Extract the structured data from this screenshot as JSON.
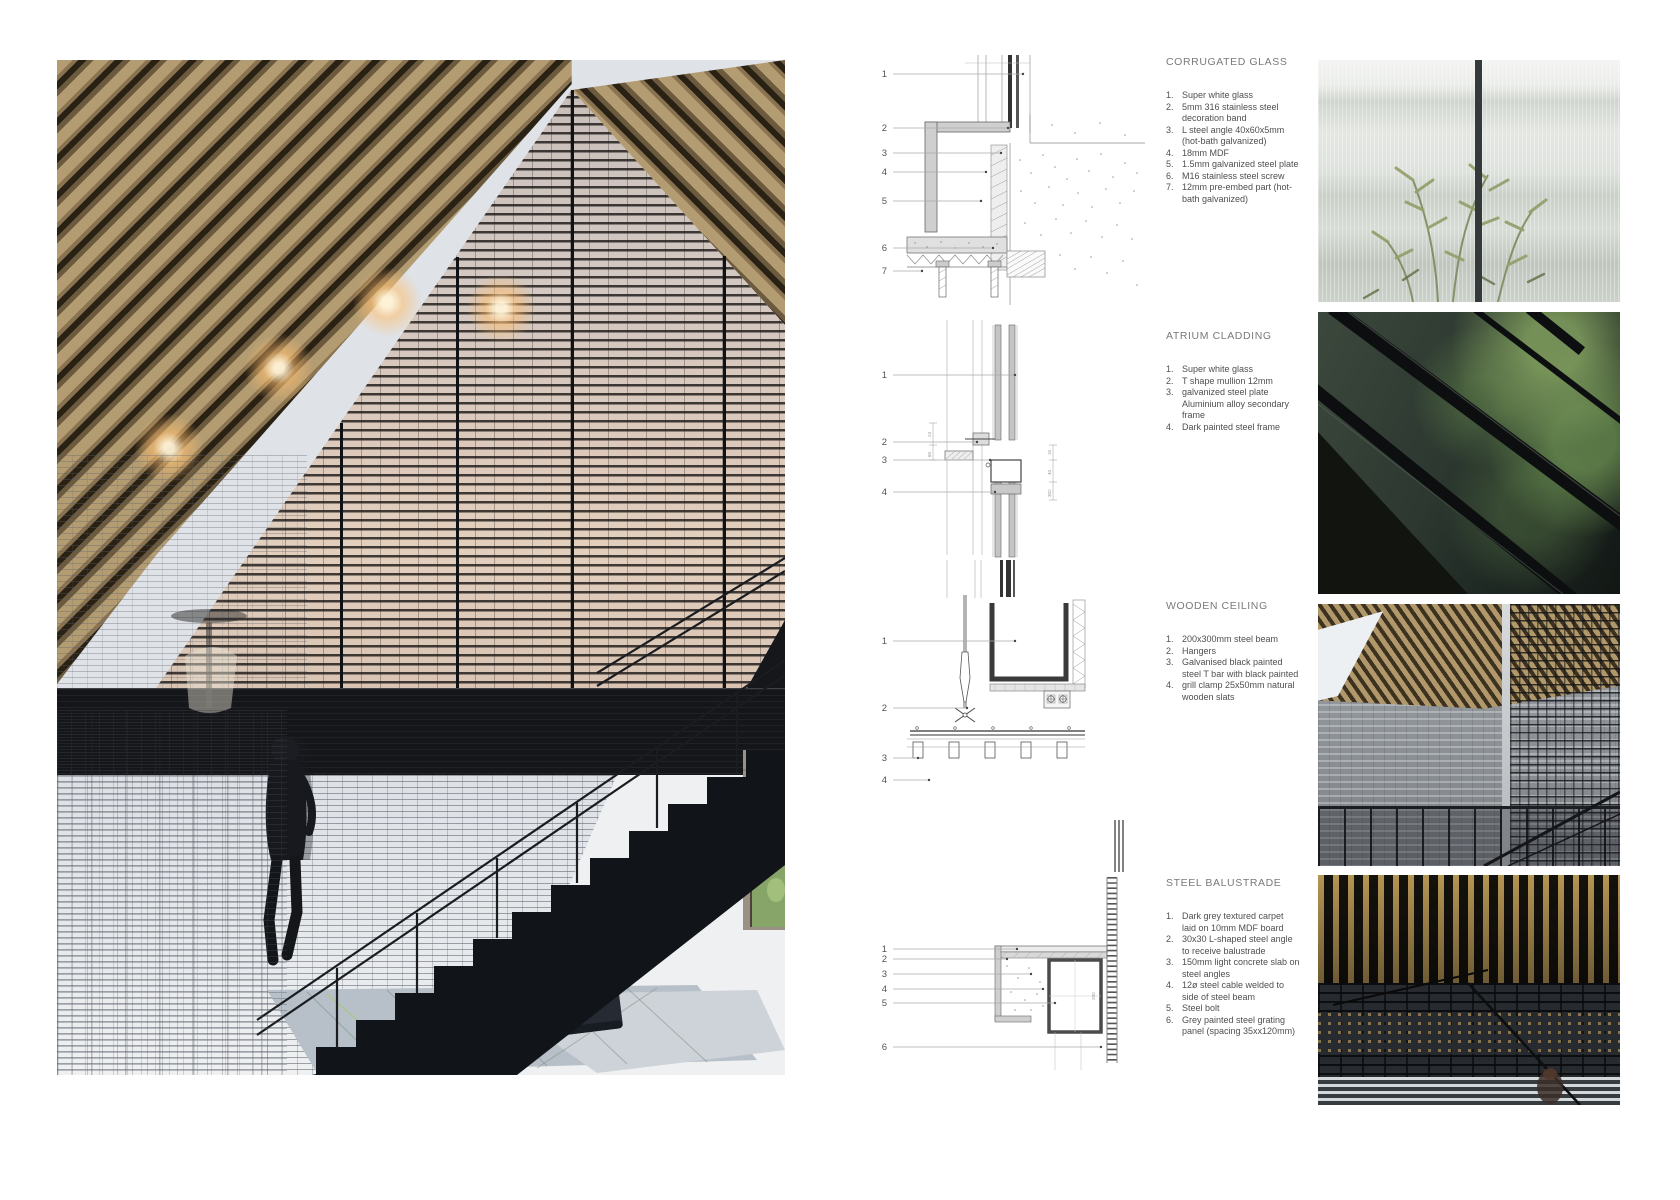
{
  "sections": [
    {
      "heading": "CORRUGATED GLASS",
      "items": [
        {
          "n": "1.",
          "text": "Super white glass"
        },
        {
          "n": "2.",
          "text": "5mm 316 stainless steel decoration band"
        },
        {
          "n": "3.",
          "text": "L steel angle 40x60x5mm (hot-bath galvanized)"
        },
        {
          "n": "4.",
          "text": "18mm MDF"
        },
        {
          "n": "5.",
          "text": "1.5mm galvanized steel plate"
        },
        {
          "n": "6.",
          "text": "M16 stainless steel screw"
        },
        {
          "n": "7.",
          "text": "12mm pre-embed part (hot-bath galvanized)"
        }
      ]
    },
    {
      "heading": "ATRIUM CLADDING",
      "items": [
        {
          "n": "1.",
          "text": "Super white glass"
        },
        {
          "n": "2.",
          "text": "T shape mullion 12mm"
        },
        {
          "n": "3.",
          "text": "galvanized steel plate Aluminium alloy secondary frame"
        },
        {
          "n": "4.",
          "text": "Dark painted steel frame"
        }
      ]
    },
    {
      "heading": "WOODEN CEILING",
      "items": [
        {
          "n": "1.",
          "text": "200x300mm steel beam"
        },
        {
          "n": "2.",
          "text": "Hangers"
        },
        {
          "n": "3.",
          "text": "Galvanised black painted steel T bar with black painted"
        },
        {
          "n": "4.",
          "text": "grill clamp 25x50mm natural wooden slats"
        }
      ]
    },
    {
      "heading": "STEEL BALUSTRADE",
      "items": [
        {
          "n": "1.",
          "text": "Dark grey textured carpet laid on 10mm MDF board"
        },
        {
          "n": "2.",
          "text": "30x30 L-shaped steel angle to receive balustrade"
        },
        {
          "n": "3.",
          "text": "150mm light concrete slab on steel angles"
        },
        {
          "n": "4.",
          "text": "12ø steel cable welded to side of steel beam"
        },
        {
          "n": "5.",
          "text": "Steel bolt"
        },
        {
          "n": "6.",
          "text": "Grey painted steel grating panel (spacing 35xx120mm)"
        }
      ]
    }
  ],
  "drawings": [
    {
      "callouts": [
        "1",
        "2",
        "3",
        "4",
        "5",
        "6",
        "7"
      ]
    },
    {
      "callouts": [
        "1",
        "2",
        "3",
        "4"
      ],
      "dims": {
        "d15": "15",
        "d40": "40",
        "d302": "302",
        "d24": "24",
        "d60": "60"
      }
    },
    {
      "callouts": [
        "1",
        "2",
        "3",
        "4"
      ]
    },
    {
      "callouts": [
        "1",
        "2",
        "3",
        "4",
        "5",
        "6"
      ],
      "dims": {
        "d200": "200"
      }
    }
  ],
  "palette": {
    "wood": "#a8906a",
    "dark_steel": "#16181b",
    "screen_warm": "#d9c6b8",
    "mesh_blue": "#dfe3e8",
    "drawing_line": "#666666",
    "text_gray": "#4f4f4f",
    "heading_gray": "#7a7a7a"
  }
}
